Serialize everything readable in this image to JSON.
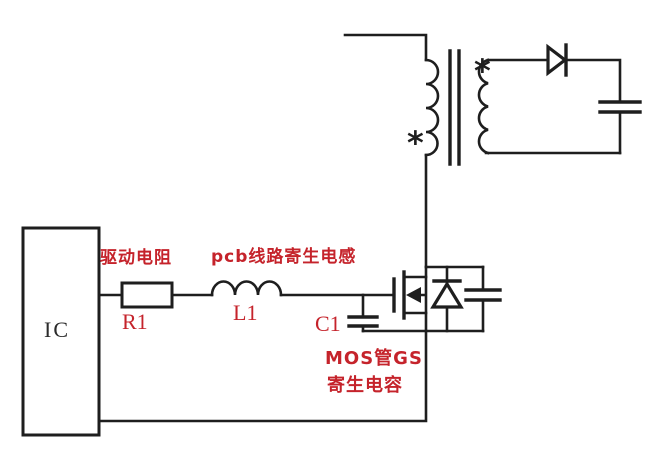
{
  "components": {
    "ic": {
      "label": "IC"
    },
    "resistor": {
      "designator": "R1",
      "annotation": "驱动电阻"
    },
    "inductor": {
      "designator": "L1",
      "annotation": "pcb线路寄生电感"
    },
    "capacitor_gs": {
      "designator": "C1",
      "annotation_line1": "MOS管GS",
      "annotation_line2": "寄生电容"
    },
    "transformer": {
      "primary_dot": "*",
      "secondary_dot": "*"
    }
  },
  "colors": {
    "wire": "#1e1e1e",
    "annotation_red": "#c5232b",
    "label_dark": "#2b2b2b",
    "background": "#ffffff"
  }
}
